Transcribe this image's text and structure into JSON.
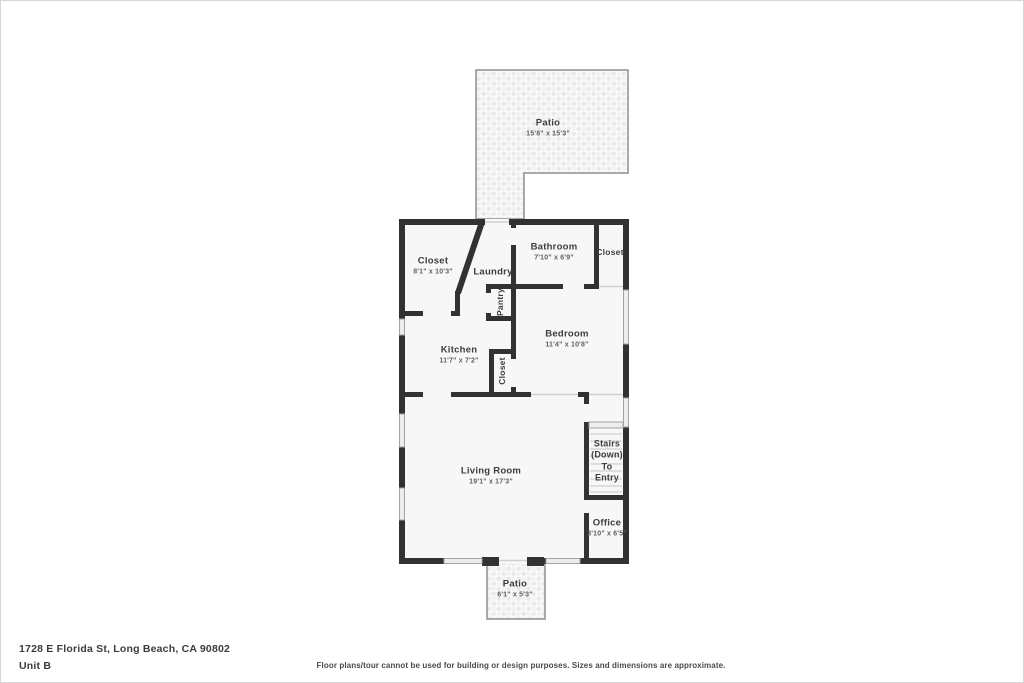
{
  "rooms": {
    "patio_top": {
      "name": "Patio",
      "dims": "15'8\" x 15'3\""
    },
    "closet_top_left": {
      "name": "Closet",
      "dims": "8'1\" x 10'3\""
    },
    "bathroom": {
      "name": "Bathroom",
      "dims": "7'10\" x 6'9\""
    },
    "closet_top_right": {
      "name": "Closet"
    },
    "laundry": {
      "name": "Laundry"
    },
    "pantry": {
      "name": "Pantry"
    },
    "kitchen": {
      "name": "Kitchen",
      "dims": "11'7\" x 7'2\""
    },
    "bedroom": {
      "name": "Bedroom",
      "dims": "11'4\" x 10'8\""
    },
    "closet_bedroom": {
      "name": "Closet"
    },
    "living_room": {
      "name": "Living Room",
      "dims": "19'1\" x 17'3\""
    },
    "stairs": {
      "lines": [
        "Stairs",
        "(Down)",
        "To",
        "Entry"
      ]
    },
    "office": {
      "name": "Office",
      "dims": "3'10\" x 6'5\""
    },
    "patio_bottom": {
      "name": "Patio",
      "dims": "6'1\" x 5'3\""
    }
  },
  "footer": {
    "address": "1728 E Florida St, Long Beach, CA 90802",
    "unit": "Unit B",
    "disclaimer": "Floor plans/tour cannot be used for building or design purposes. Sizes and dimensions are approximate."
  },
  "colors": {
    "wall": "#323232",
    "room_fill": "#f7f7f7",
    "window_fill": "#ededed",
    "window_stroke": "#a3a3a3",
    "patio_border": "#8f8f8f",
    "opening_line": "#cfcfcf",
    "label_text": "#3d3d3d",
    "dims_text": "#5f5f5f"
  }
}
